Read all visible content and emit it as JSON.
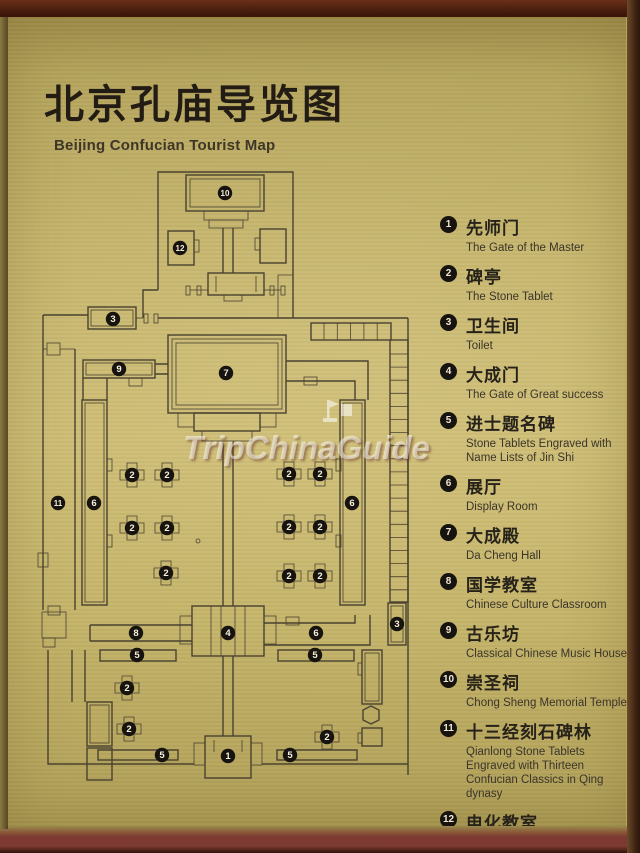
{
  "title": {
    "zh": "北京孔庙导览图",
    "en": "Beijing Confucian Tourist Map"
  },
  "watermark": {
    "text": "TripChinaGuide",
    "logo": "pagoda-flag-logo"
  },
  "colors": {
    "brass": "#c0af65",
    "frame_top": "#471c0e",
    "frame_bottom": "#7c3a32",
    "map_ink": "#4a4230",
    "marker_bg": "#17130e",
    "marker_fg": "#f5efdc"
  },
  "legend": {
    "items": [
      {
        "num": "1",
        "zh": "先师门",
        "en": "The Gate of the Master"
      },
      {
        "num": "2",
        "zh": "碑亭",
        "en": "The Stone Tablet"
      },
      {
        "num": "3",
        "zh": "卫生间",
        "en": "Toilet"
      },
      {
        "num": "4",
        "zh": "大成门",
        "en": "The Gate of Great success"
      },
      {
        "num": "5",
        "zh": "进士题名碑",
        "en": "Stone Tablets Engraved with Name Lists of Jin Shi"
      },
      {
        "num": "6",
        "zh": "展厅",
        "en": "Display Room"
      },
      {
        "num": "7",
        "zh": "大成殿",
        "en": "Da Cheng Hall"
      },
      {
        "num": "8",
        "zh": "国学教室",
        "en": "Chinese Culture Classroom"
      },
      {
        "num": "9",
        "zh": "古乐坊",
        "en": "Classical Chinese Music House"
      },
      {
        "num": "10",
        "zh": "崇圣祠",
        "en": "Chong Sheng Memorial Temple"
      },
      {
        "num": "11",
        "zh": "十三经刻石碑林",
        "en": "Qianlong Stone Tablets Engraved with Thirteen Confucian Classics in Qing dynasy"
      },
      {
        "num": "12",
        "zh": "电化教室",
        "en": "Classroom"
      }
    ]
  },
  "map": {
    "markers": [
      {
        "n": "10",
        "x": 197,
        "y": 30
      },
      {
        "n": "12",
        "x": 152,
        "y": 85
      },
      {
        "n": "3",
        "x": 85,
        "y": 156
      },
      {
        "n": "9",
        "x": 91,
        "y": 206
      },
      {
        "n": "7",
        "x": 198,
        "y": 210
      },
      {
        "n": "11",
        "x": 30,
        "y": 340
      },
      {
        "n": "6",
        "x": 66,
        "y": 340
      },
      {
        "n": "6",
        "x": 324,
        "y": 340
      },
      {
        "n": "2",
        "x": 104,
        "y": 312,
        "pav": true
      },
      {
        "n": "2",
        "x": 139,
        "y": 312,
        "pav": true
      },
      {
        "n": "2",
        "x": 261,
        "y": 311,
        "pav": true
      },
      {
        "n": "2",
        "x": 292,
        "y": 311,
        "pav": true
      },
      {
        "n": "2",
        "x": 104,
        "y": 365,
        "pav": true
      },
      {
        "n": "2",
        "x": 139,
        "y": 365,
        "pav": true
      },
      {
        "n": "2",
        "x": 261,
        "y": 364,
        "pav": true
      },
      {
        "n": "2",
        "x": 292,
        "y": 364,
        "pav": true
      },
      {
        "n": "2",
        "x": 138,
        "y": 410,
        "pav": true
      },
      {
        "n": "2",
        "x": 261,
        "y": 413,
        "pav": true
      },
      {
        "n": "2",
        "x": 292,
        "y": 413,
        "pav": true
      },
      {
        "n": "8",
        "x": 108,
        "y": 470
      },
      {
        "n": "4",
        "x": 200,
        "y": 470
      },
      {
        "n": "6",
        "x": 288,
        "y": 470
      },
      {
        "n": "5",
        "x": 109,
        "y": 492
      },
      {
        "n": "5",
        "x": 287,
        "y": 492
      },
      {
        "n": "2",
        "x": 99,
        "y": 525,
        "pav": true
      },
      {
        "n": "2",
        "x": 101,
        "y": 566,
        "pav": true
      },
      {
        "n": "2",
        "x": 299,
        "y": 574,
        "pav": true
      },
      {
        "n": "5",
        "x": 134,
        "y": 592
      },
      {
        "n": "5",
        "x": 262,
        "y": 592
      },
      {
        "n": "1",
        "x": 200,
        "y": 593
      },
      {
        "n": "3",
        "x": 369,
        "y": 461
      }
    ]
  }
}
